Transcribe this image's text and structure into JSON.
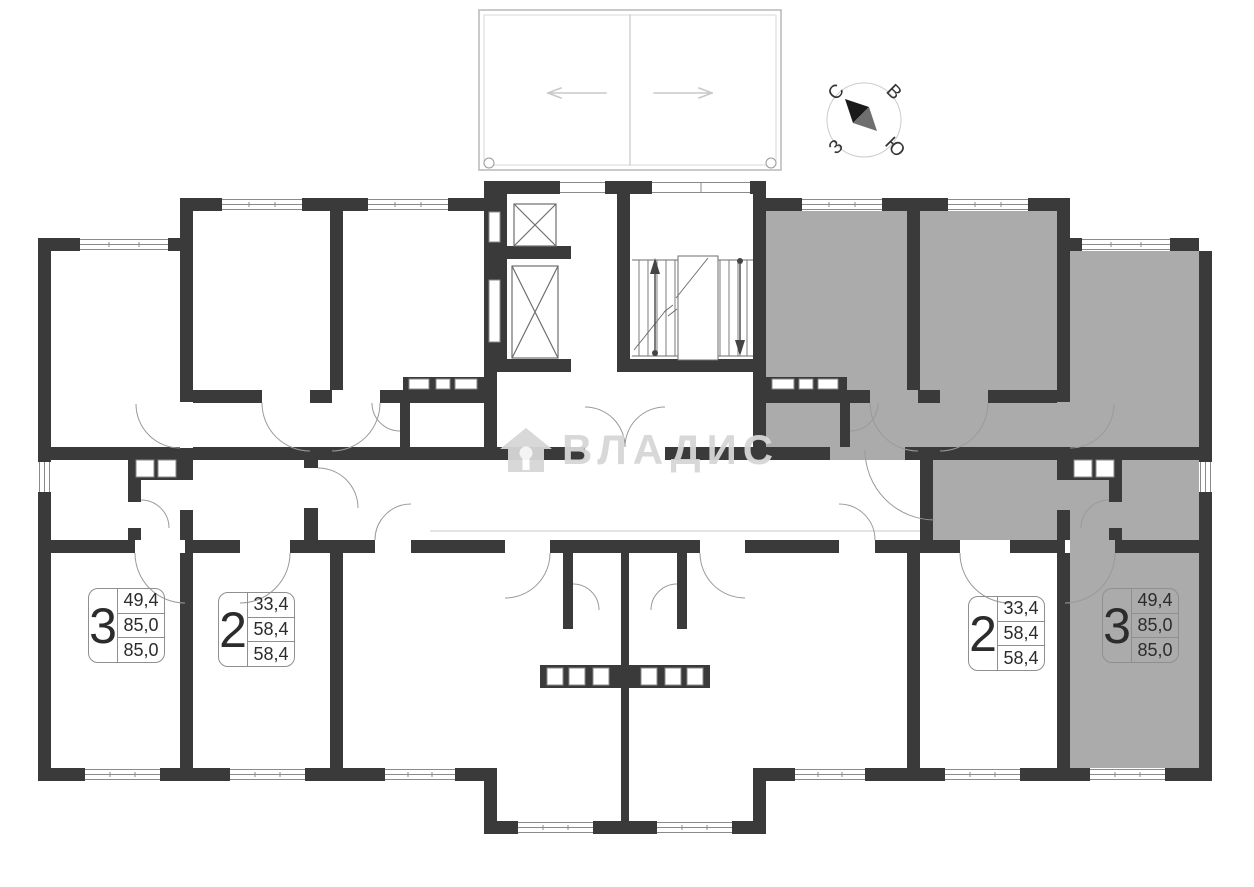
{
  "compass": {
    "north": "С",
    "east": "В",
    "south": "Ю",
    "west": "З"
  },
  "watermark": {
    "brand": "ВЛАДИС"
  },
  "apartments": [
    {
      "rooms": "3",
      "areas": [
        "49,4",
        "85,0",
        "85,0"
      ],
      "highlighted": false,
      "position": "bottom-left"
    },
    {
      "rooms": "2",
      "areas": [
        "33,4",
        "58,4",
        "58,4"
      ],
      "highlighted": false,
      "position": "bottom-left-center"
    },
    {
      "rooms": "2",
      "areas": [
        "33,4",
        "58,4",
        "58,4"
      ],
      "highlighted": false,
      "position": "bottom-right-center"
    },
    {
      "rooms": "3",
      "areas": [
        "49,4",
        "85,0",
        "85,0"
      ],
      "highlighted": true,
      "position": "bottom-right"
    }
  ],
  "colors": {
    "wall": "#3a3a3a",
    "highlight_fill": "#ababab",
    "drawing_line": "#8a8a8a",
    "watermark": "#d6d6d6"
  }
}
